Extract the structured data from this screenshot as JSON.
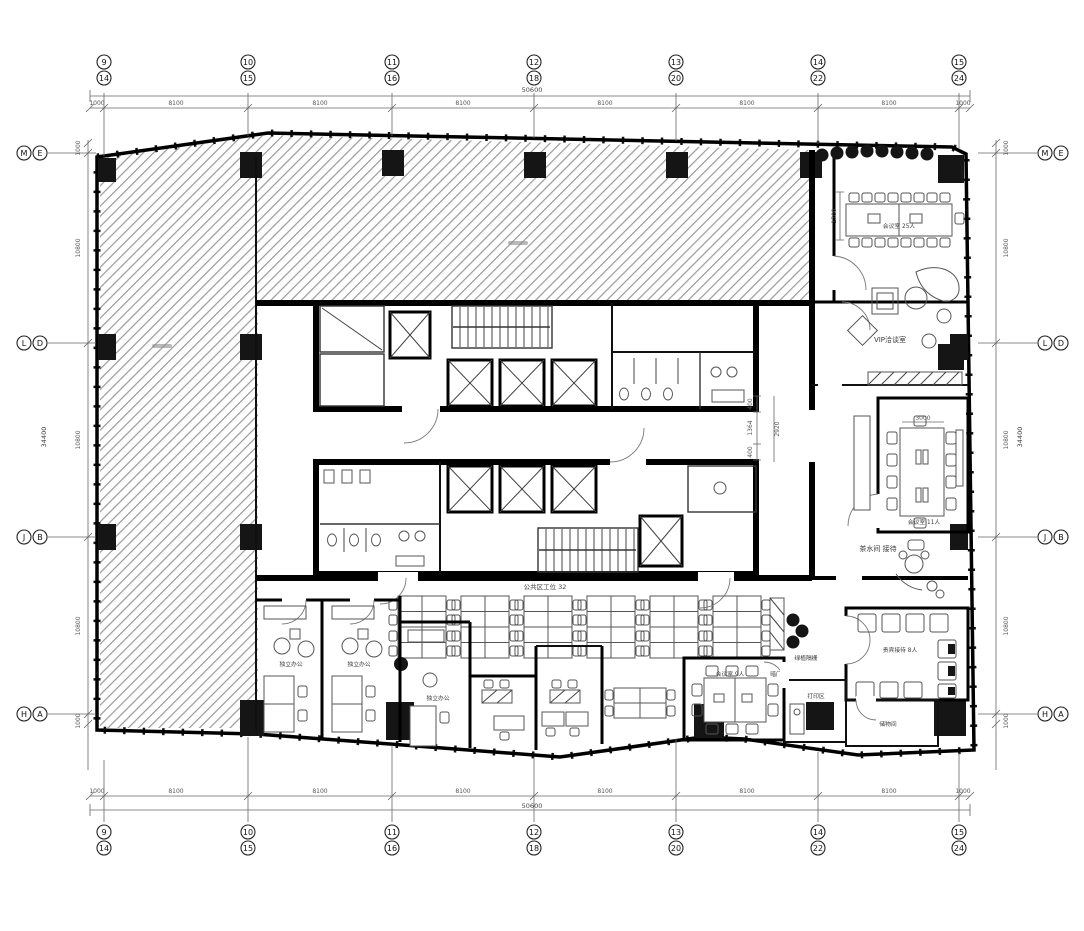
{
  "plan": {
    "colors": {
      "wall": "#000000",
      "hatch": "#9a9a9a",
      "annotation": "#555555"
    },
    "grid_top": {
      "primary": [
        "9",
        "10",
        "11",
        "12",
        "13",
        "14",
        "15"
      ],
      "secondary": [
        "14",
        "15",
        "16",
        "18",
        "20",
        "22",
        "24"
      ]
    },
    "grid_side": {
      "primary": [
        "M",
        "L",
        "J",
        "H"
      ],
      "secondary": [
        "E",
        "D",
        "B",
        "A"
      ]
    },
    "dims_top": {
      "total": "50600",
      "margin": "1000",
      "bay": "8100"
    },
    "dims_side": {
      "total": "34400",
      "margin": "1000",
      "bay": "10800"
    },
    "dims_inner": {
      "w1": "400",
      "w2": "1364",
      "w3": "400",
      "h1": "2920",
      "t1": "3000",
      "t2": "1700"
    },
    "labels": {
      "conf_large": "会议室 25人",
      "vip_room": "VIP洽谈室",
      "conf_mid": "会议室 11人",
      "pantry": "茶水间 接待",
      "vip_reception": "贵宾接待 8人",
      "storage": "储物间",
      "print_area": "打印区",
      "hidden_door": "暗门",
      "plant_screen": "绿植隔栅",
      "open_office": "公共区工位 32",
      "office1": "独立办公",
      "office2": "独立办公",
      "office3": "独立办公",
      "conf_small": "会议室 9人"
    }
  }
}
